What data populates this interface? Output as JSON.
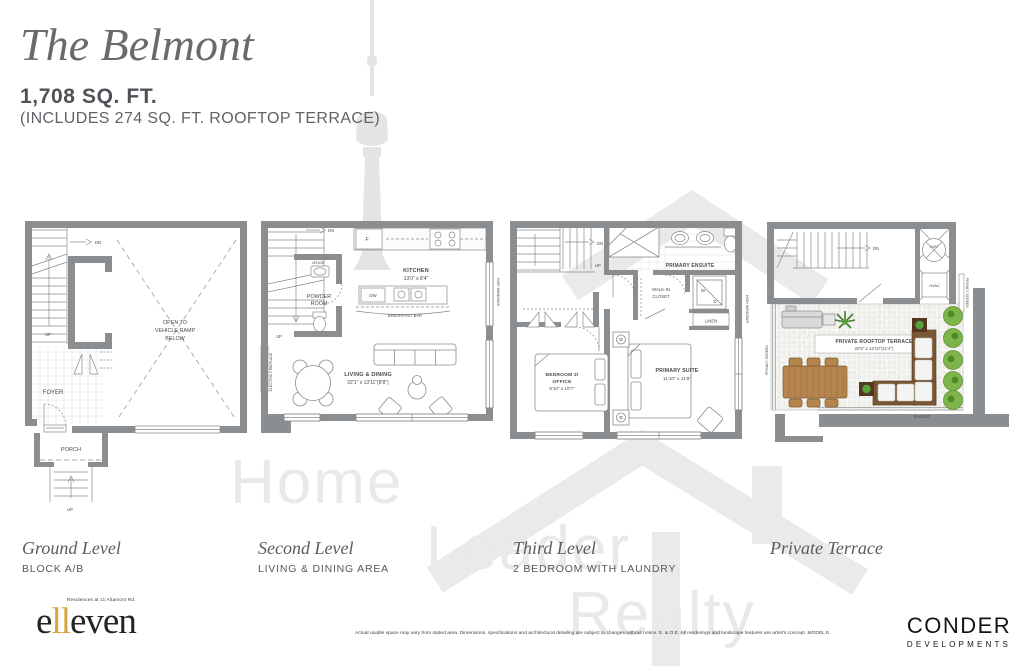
{
  "header": {
    "title": "The Belmont",
    "area": "1,708 SQ. FT.",
    "area_note": "(INCLUDES 274 SQ. FT. ROOFTOP TERRACE)"
  },
  "watermark": {
    "word1": "Home",
    "word2": "Leader",
    "word3": "Realty"
  },
  "ground": {
    "caption": "Ground Level",
    "subcaption": "BLOCK A/B",
    "open1": "OPEN TO",
    "open2": "VEHICLE RAMP",
    "open3": "BELOW",
    "foyer": "FOYER",
    "porch": "PORCH",
    "dn": "DN",
    "up": "UP",
    "up_entry": "UP"
  },
  "second": {
    "caption": "Second Level",
    "subcaption": "LIVING & DINING AREA",
    "kitchen": "KITCHEN",
    "kitchen_dim": "13'0\" x 8'4\"",
    "ledge": "LEDGE",
    "powder1": "POWDER",
    "powder2": "ROOM",
    "f": "F",
    "dw": "DW",
    "breakfast_bar": "BREAKFAST BAR",
    "living": "LIVING & DINING",
    "living_dim": "22'1\" x 13'11\"(8'8\")",
    "fireplace": "ELECTRIC FIREPLACE",
    "high_windows": "HIGH WINDOWS",
    "dn": "DN",
    "up": "UP"
  },
  "third": {
    "caption": "Third Level",
    "subcaption": "2 BEDROOM WITH LAUNDRY",
    "ensuite": "PRIMARY ENSUITE",
    "walkin1": "WALK-IN",
    "walkin2": "CLOSET",
    "w": "W",
    "d": "D",
    "linen": "LINEN",
    "bedroom1": "BEDROOM 2/",
    "bedroom2": "OFFICE",
    "bedroom_dim": "9'10\" x 10'7\"",
    "primary": "PRIMARY SUITE",
    "primary_dim": "11'10\" x 11'8\"",
    "high_windows": "HIGH WINDOWS",
    "dn": "DN",
    "up": "UP"
  },
  "terrace": {
    "caption": "Private Terrace",
    "title": "PRIVATE ROOFTOP TERRACE",
    "dim": "22'5\" x 13'10\"(11'4\")",
    "hwt": "HWT",
    "hvac": "HVAC",
    "privacy_left": "PRIVACY SCREEN",
    "privacy_right": "PRIVACY SCREEN",
    "railing": "RAILING",
    "dn": "DN"
  },
  "footer": {
    "logo_tagline": "Residences at 11 Altamont Rd.",
    "logo_e": "e",
    "logo_ll": "ll",
    "logo_even": "even",
    "disclaimer": "Actual usable space may vary from stated area. Dimensions, specifications and architectural detailing are subject to changes without notice. E. & O.E. All renderings and landscape features are artist's concept.  MODEL E.",
    "developer_name": "CONDER",
    "developer_sub": "DEVELOPMENTS"
  },
  "colors": {
    "wall": "#8b8e90",
    "accent_gold": "#d9a43b",
    "greenery": "#7db54a",
    "wood": "#b5854d",
    "watermark": "#e9e9e9"
  }
}
